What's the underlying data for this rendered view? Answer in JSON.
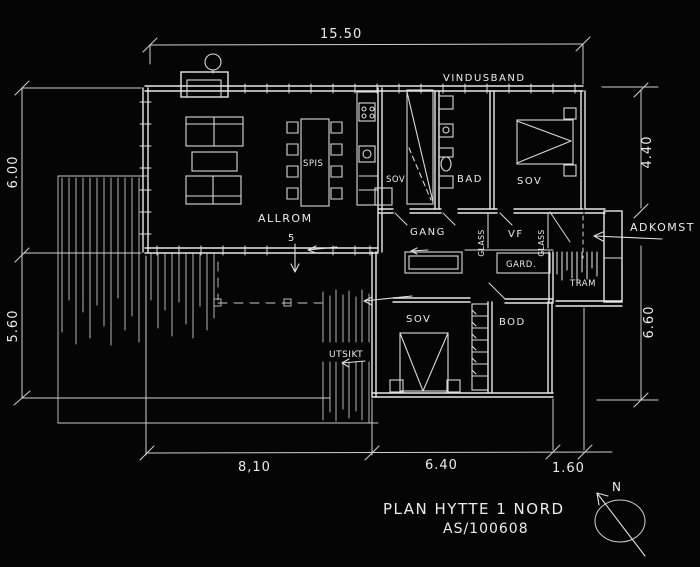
{
  "colors": {
    "background": "#050505",
    "ink": "#e8e8e8"
  },
  "dimensions": {
    "top": "15.50",
    "left_upper": "6.00",
    "left_lower": "5.60",
    "bottom_left": "8,10",
    "bottom_middle": "6.40",
    "bottom_right": "1.60",
    "right_upper": "4.40",
    "right_lower": "6.60",
    "door_width": "5"
  },
  "rooms": {
    "allrom": "ALLROM",
    "spis": "SPIS",
    "sov_small": "SOV",
    "bad": "BAD",
    "sov_master": "SOV",
    "gang": "GANG",
    "vf": "VF",
    "gard": "GARD.",
    "tram": "TRAM",
    "sov_south": "SOV",
    "bod": "BOD"
  },
  "annotations": {
    "vindusband": "VINDUSBAND",
    "adkomst": "ADKOMST",
    "utsikt": "UTSIKT",
    "glass_west": "GLASS",
    "glass_east": "GLASS"
  },
  "title_block": {
    "title": "PLAN HYTTE 1 NORD",
    "signature": "AS/100608",
    "north": "N"
  }
}
